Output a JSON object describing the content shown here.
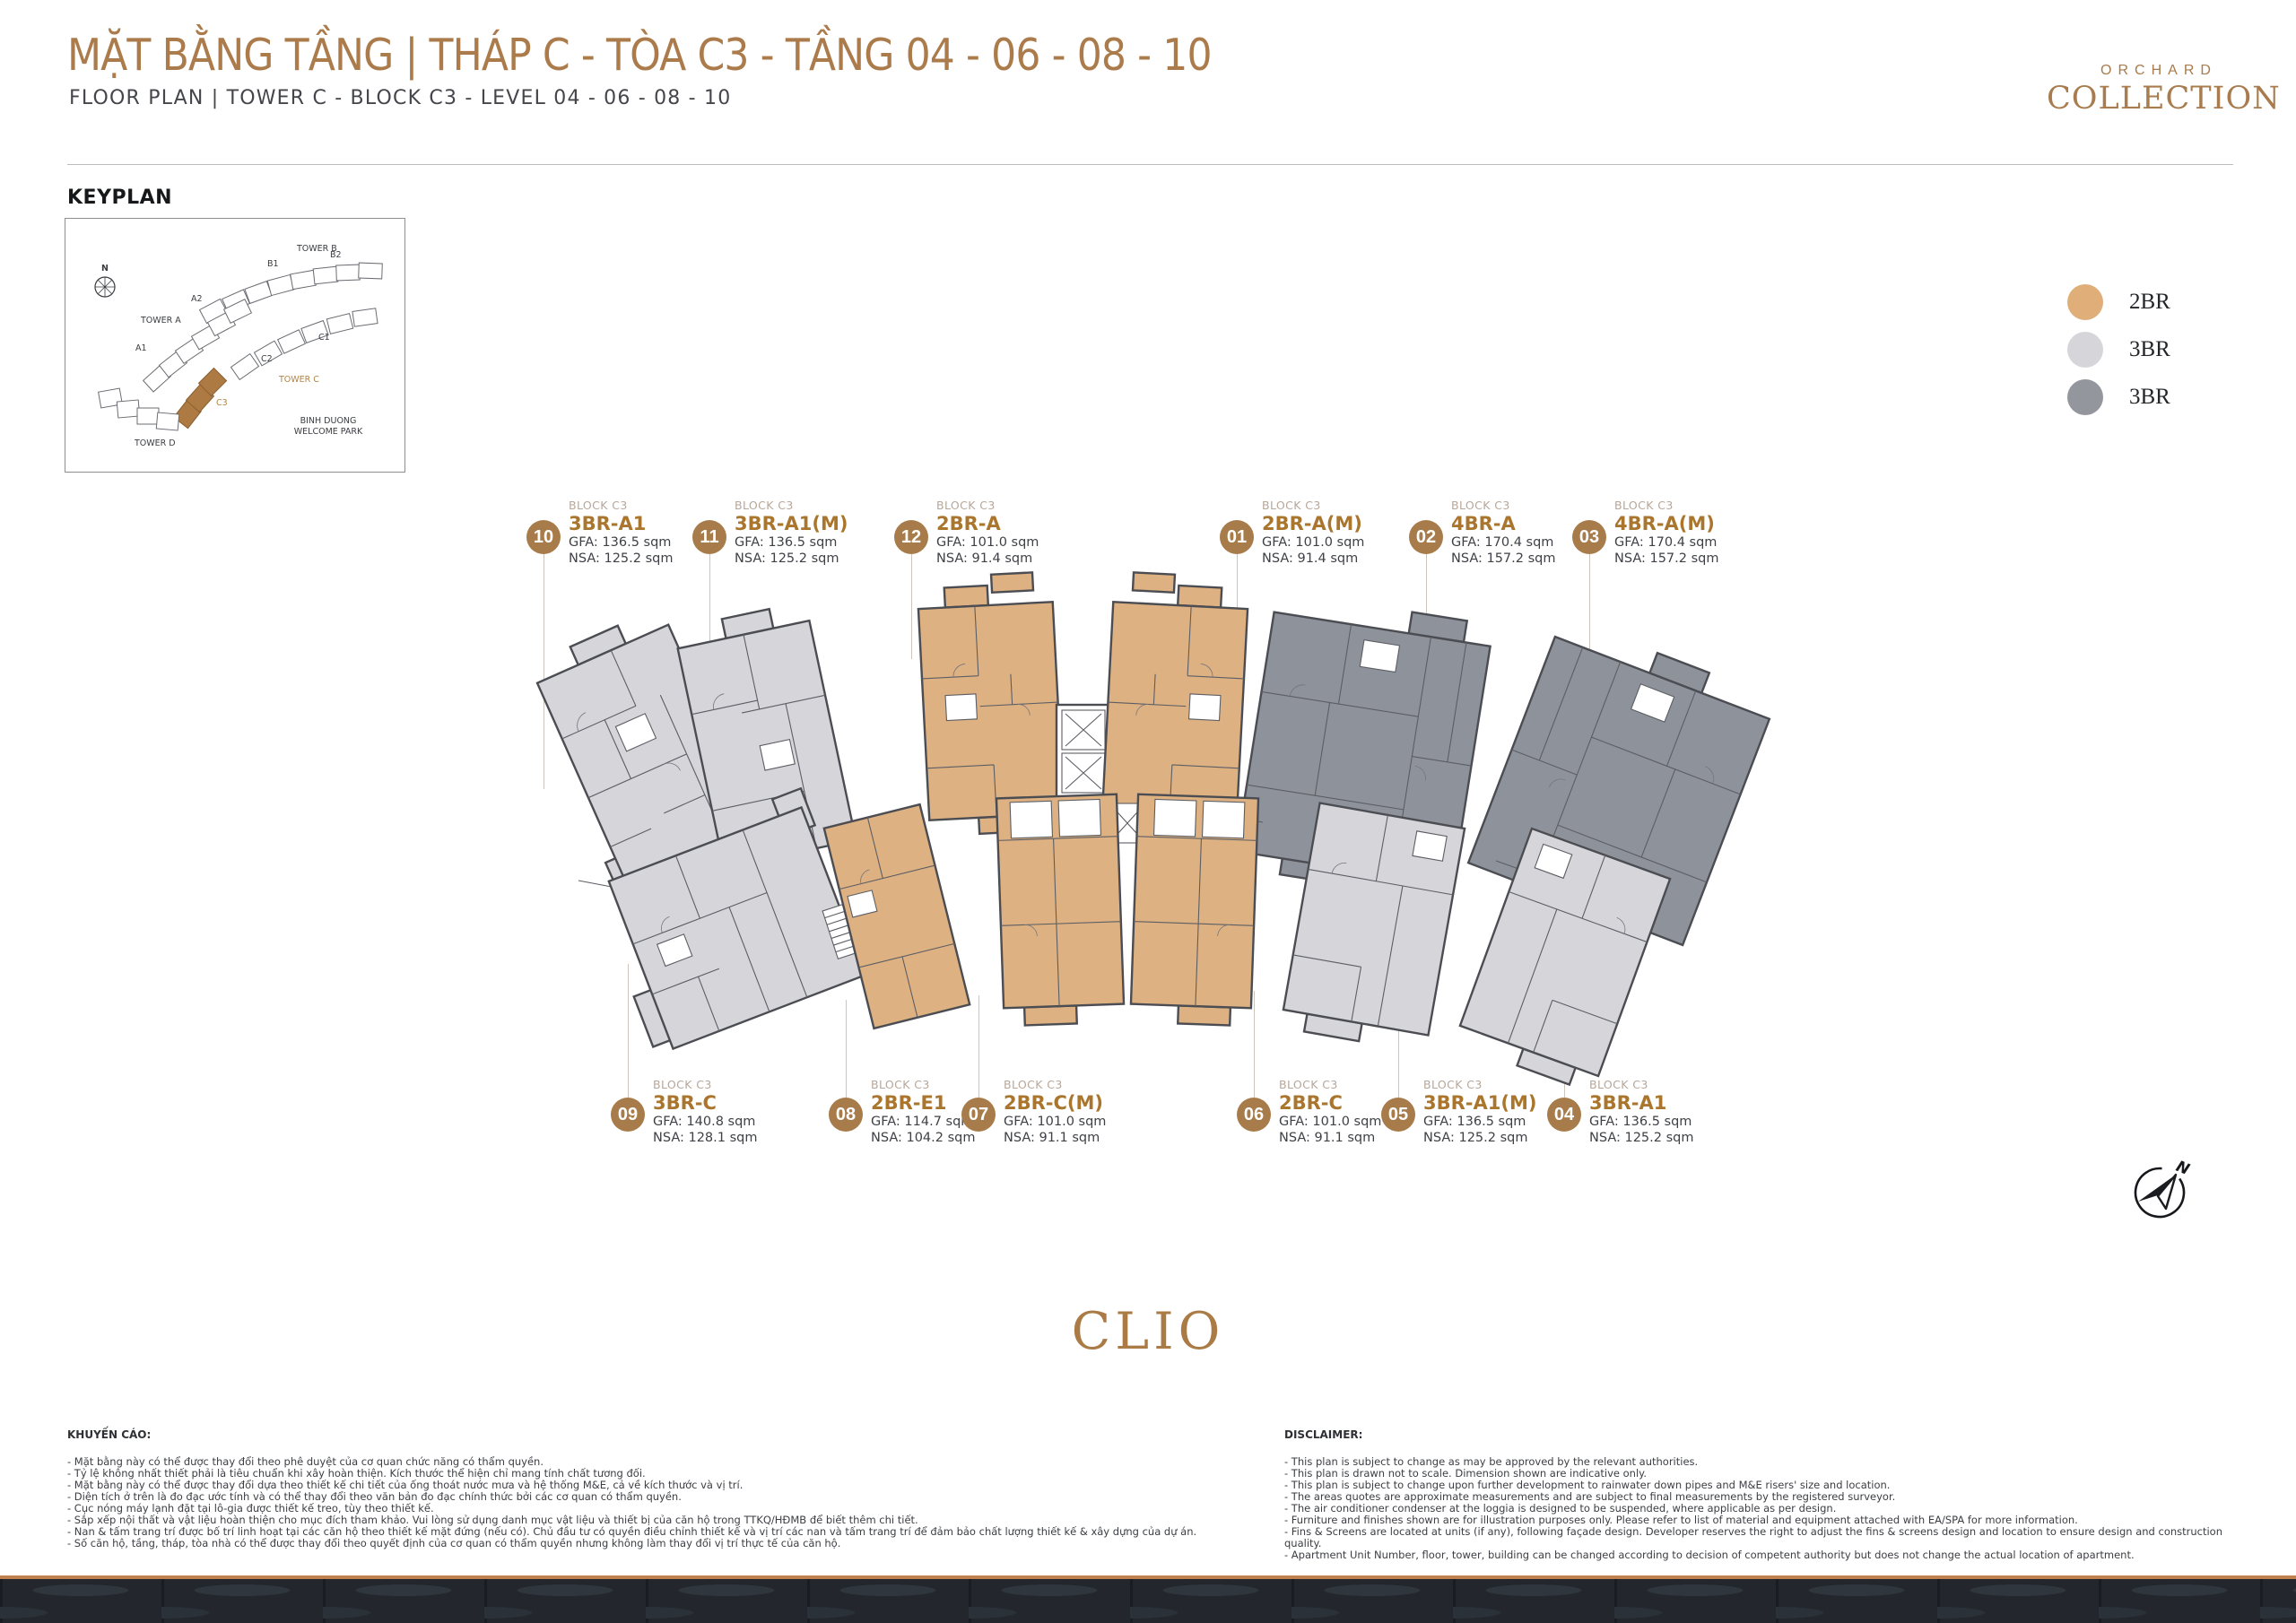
{
  "header": {
    "title_vi": "MẶT BẰNG TẦNG  |  THÁP C - TÒA C3 - TẦNG 04 - 06 - 08 - 10",
    "title_en": "FLOOR PLAN  |  TOWER C - BLOCK C3 - LEVEL 04 - 06 - 08 - 10",
    "brand_line1": "ORCHARD",
    "brand_line2": "COLLECTION"
  },
  "keyplan": {
    "heading": "KEYPLAN",
    "compass": "N",
    "tower_b": "TOWER B",
    "b1": "B1",
    "b2": "B2",
    "tower_a": "TOWER A",
    "a1": "A1",
    "a2": "A2",
    "c1": "C1",
    "c2": "C2",
    "tower_c": "TOWER C",
    "c3": "C3",
    "tower_d": "TOWER D",
    "park_line1": "BINH DUONG",
    "park_line2": "WELCOME PARK"
  },
  "legend": {
    "items": [
      {
        "label": "2BR",
        "color": "#dfae79"
      },
      {
        "label": "3BR",
        "color": "#d6d6da"
      },
      {
        "label": "3BR",
        "color": "#94969e"
      }
    ]
  },
  "units_top": [
    {
      "number": "10",
      "block": "BLOCK C3",
      "name": "3BR-A1",
      "gfa": "GFA: 136.5 sqm",
      "nsa": "NSA: 125.2 sqm"
    },
    {
      "number": "11",
      "block": "BLOCK C3",
      "name": "3BR-A1(M)",
      "gfa": "GFA: 136.5 sqm",
      "nsa": "NSA: 125.2 sqm"
    },
    {
      "number": "12",
      "block": "BLOCK C3",
      "name": "2BR-A",
      "gfa": "GFA: 101.0 sqm",
      "nsa": "NSA: 91.4 sqm"
    },
    {
      "number": "01",
      "block": "BLOCK C3",
      "name": "2BR-A(M)",
      "gfa": "GFA: 101.0 sqm",
      "nsa": "NSA: 91.4 sqm"
    },
    {
      "number": "02",
      "block": "BLOCK C3",
      "name": "4BR-A",
      "gfa": "GFA: 170.4 sqm",
      "nsa": "NSA: 157.2 sqm"
    },
    {
      "number": "03",
      "block": "BLOCK C3",
      "name": "4BR-A(M)",
      "gfa": "GFA: 170.4 sqm",
      "nsa": "NSA: 157.2 sqm"
    }
  ],
  "units_bottom": [
    {
      "number": "09",
      "block": "BLOCK C3",
      "name": "3BR-C",
      "gfa": "GFA: 140.8 sqm",
      "nsa": "NSA: 128.1 sqm"
    },
    {
      "number": "08",
      "block": "BLOCK C3",
      "name": "2BR-E1",
      "gfa": "GFA: 114.7 sqm",
      "nsa": "NSA: 104.2 sqm"
    },
    {
      "number": "07",
      "block": "BLOCK C3",
      "name": "2BR-C(M)",
      "gfa": "GFA: 101.0 sqm",
      "nsa": "NSA: 91.1 sqm"
    },
    {
      "number": "06",
      "block": "BLOCK C3",
      "name": "2BR-C",
      "gfa": "GFA: 101.0 sqm",
      "nsa": "NSA: 91.1 sqm"
    },
    {
      "number": "05",
      "block": "BLOCK C3",
      "name": "3BR-A1(M)",
      "gfa": "GFA: 136.5 sqm",
      "nsa": "NSA: 125.2 sqm"
    },
    {
      "number": "04",
      "block": "BLOCK C3",
      "name": "3BR-A1",
      "gfa": "GFA: 136.5 sqm",
      "nsa": "NSA: 125.2 sqm"
    }
  ],
  "project_name": "CLIO",
  "compass_label": "N",
  "colors": {
    "accent_brown": "#ab7b4b",
    "unit_name_brown": "#aa762e",
    "callout_circle": "#a87c4a",
    "unit_tan": "#ddb181",
    "unit_light_gray": "#d6d6da",
    "unit_dark_gray": "#8e929b",
    "footer_line": "#c0804d",
    "footer_band": "#23272d"
  },
  "advisory": {
    "heading": "KHUYẾN CÁO:",
    "lines": [
      "- Mặt bằng này có thể được thay đổi theo phê duyệt của cơ quan chức năng có thẩm quyền.",
      "- Tỷ lệ không nhất thiết phải là tiêu chuẩn khi xây hoàn thiện. Kích thước thể hiện chỉ mang tính chất tương đối.",
      "- Mặt bằng này có thể được thay đổi dựa theo thiết kế chi tiết của ống thoát nước mưa và hệ thống M&E, cả về kích thước và vị trí.",
      "- Diện tích ở trên là đo đạc ước tính và có thể thay đổi theo văn bản đo đạc chính thức bởi các cơ quan có thẩm quyền.",
      "- Cục nóng máy lạnh đặt tại lô-gia được thiết kế treo, tùy theo thiết kế.",
      "- Sắp xếp nội thất và vật liệu hoàn thiện cho mục đích tham khảo. Vui lòng sử dụng danh mục vật liệu và thiết bị của căn hộ trong TTKQ/HĐMB để biết thêm chi tiết.",
      "- Nan & tấm trang trí được bố trí linh hoạt tại các căn hộ theo thiết kế mặt đứng (nếu có). Chủ đầu tư có quyền điều chỉnh thiết kế và vị trí các nan và tấm trang trí để đảm bảo chất lượng thiết kế & xây dựng của dự án.",
      "- Số căn hộ, tầng, tháp, tòa nhà có thể được thay đổi theo quyết định của cơ quan có thẩm quyền nhưng không làm thay đổi vị trí thực tế của căn hộ."
    ]
  },
  "disclaimer": {
    "heading": "DISCLAIMER:",
    "lines": [
      "- This plan is subject to change as may be approved by the relevant authorities.",
      "- This plan is drawn not to scale. Dimension shown are indicative only.",
      "- This plan is subject to change upon further development to rainwater down pipes and M&E risers' size and location.",
      "- The areas quotes are approximate measurements and are subject to final measurements by the registered surveyor.",
      "- The air conditioner condenser at the loggia is designed to be suspended, where applicable as per design.",
      "- Furniture and finishes shown are for illustration purposes only. Please refer to list of material and equipment attached with EA/SPA for more information.",
      "- Fins & Screens are located at units (if any), following façade design. Developer reserves the right to adjust the fins & screens design and location to ensure design and construction quality.",
      "- Apartment Unit Number, floor, tower, building can be changed according to decision of competent authority but does not change the actual location of apartment."
    ]
  }
}
